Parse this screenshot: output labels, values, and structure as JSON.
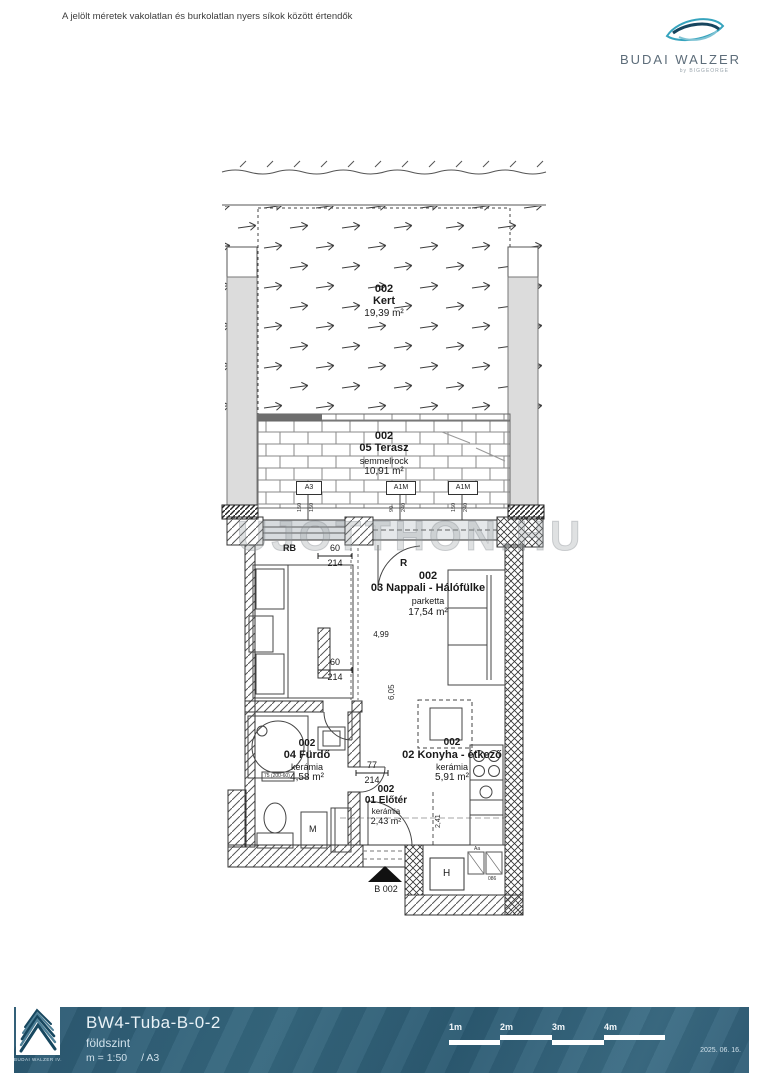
{
  "page": {
    "disclaimer": "A jelölt méretek vakolatlan és burkolatlan nyers síkok között értendők",
    "watermark": "UJOTTHON.HU"
  },
  "brand": {
    "name": "BUDAI WALZER",
    "byline": "by BIGGEORGE"
  },
  "plan": {
    "rooms": {
      "kert": {
        "code": "002",
        "name": "Kert",
        "material": "",
        "area": "19,39 m²"
      },
      "terasz": {
        "code": "002",
        "name": "05 Terasz",
        "material": "semmelrock",
        "area": "10,91 m²"
      },
      "nappali": {
        "code": "002",
        "name": "03 Nappali - Hálófülke",
        "material": "parketta",
        "area": "17,54 m²"
      },
      "furdo": {
        "code": "002",
        "name": "04 Fürdő",
        "material": "kerámia",
        "area": "4,58 m²"
      },
      "konyha": {
        "code": "002",
        "name": "02 Konyha - étkező",
        "material": "kerámia",
        "area": "5,91 m²"
      },
      "eloter": {
        "code": "002",
        "name": "01 Előtér",
        "material": "kerámia",
        "area": "2,43 m²"
      }
    },
    "tags": {
      "a3": "A3",
      "a1m_1": "A1M",
      "a1m_2": "A1M",
      "rb": "RB",
      "r": "R",
      "m": "M",
      "h": "H",
      "entry": "B 002",
      "bath_note": "75 (200-60)",
      "appliance_1": "Aa",
      "appliance_2": "086"
    },
    "dims": {
      "win1_w": "60",
      "win1_h": "214",
      "win2_w": "60",
      "win2_h": "214",
      "door_w": "77",
      "door_h": "214",
      "len": "4,99",
      "depth": "6,05",
      "kitchen_w": "2,41",
      "a3_s1": "150",
      "a3_s2": "150",
      "a1m1_s1": "90",
      "a1m1_s2": "240",
      "a1m2_s1": "150",
      "a1m2_s2": "240"
    }
  },
  "footer": {
    "code": "BW4-Tuba-B-0-2",
    "floor": "földszint",
    "scale": "m = 1:50",
    "sheet": "/ A3",
    "date": "2025. 06. 16.",
    "logo_caption": "BUDAI WALZER IV.",
    "scalebar": {
      "l1": "1m",
      "l2": "2m",
      "l3": "3m",
      "l4": "4m"
    }
  },
  "colors": {
    "bar": "#2f617b",
    "accent": "#35a3bd",
    "wall": "#dcdcdc",
    "line": "#3c3c3c"
  }
}
